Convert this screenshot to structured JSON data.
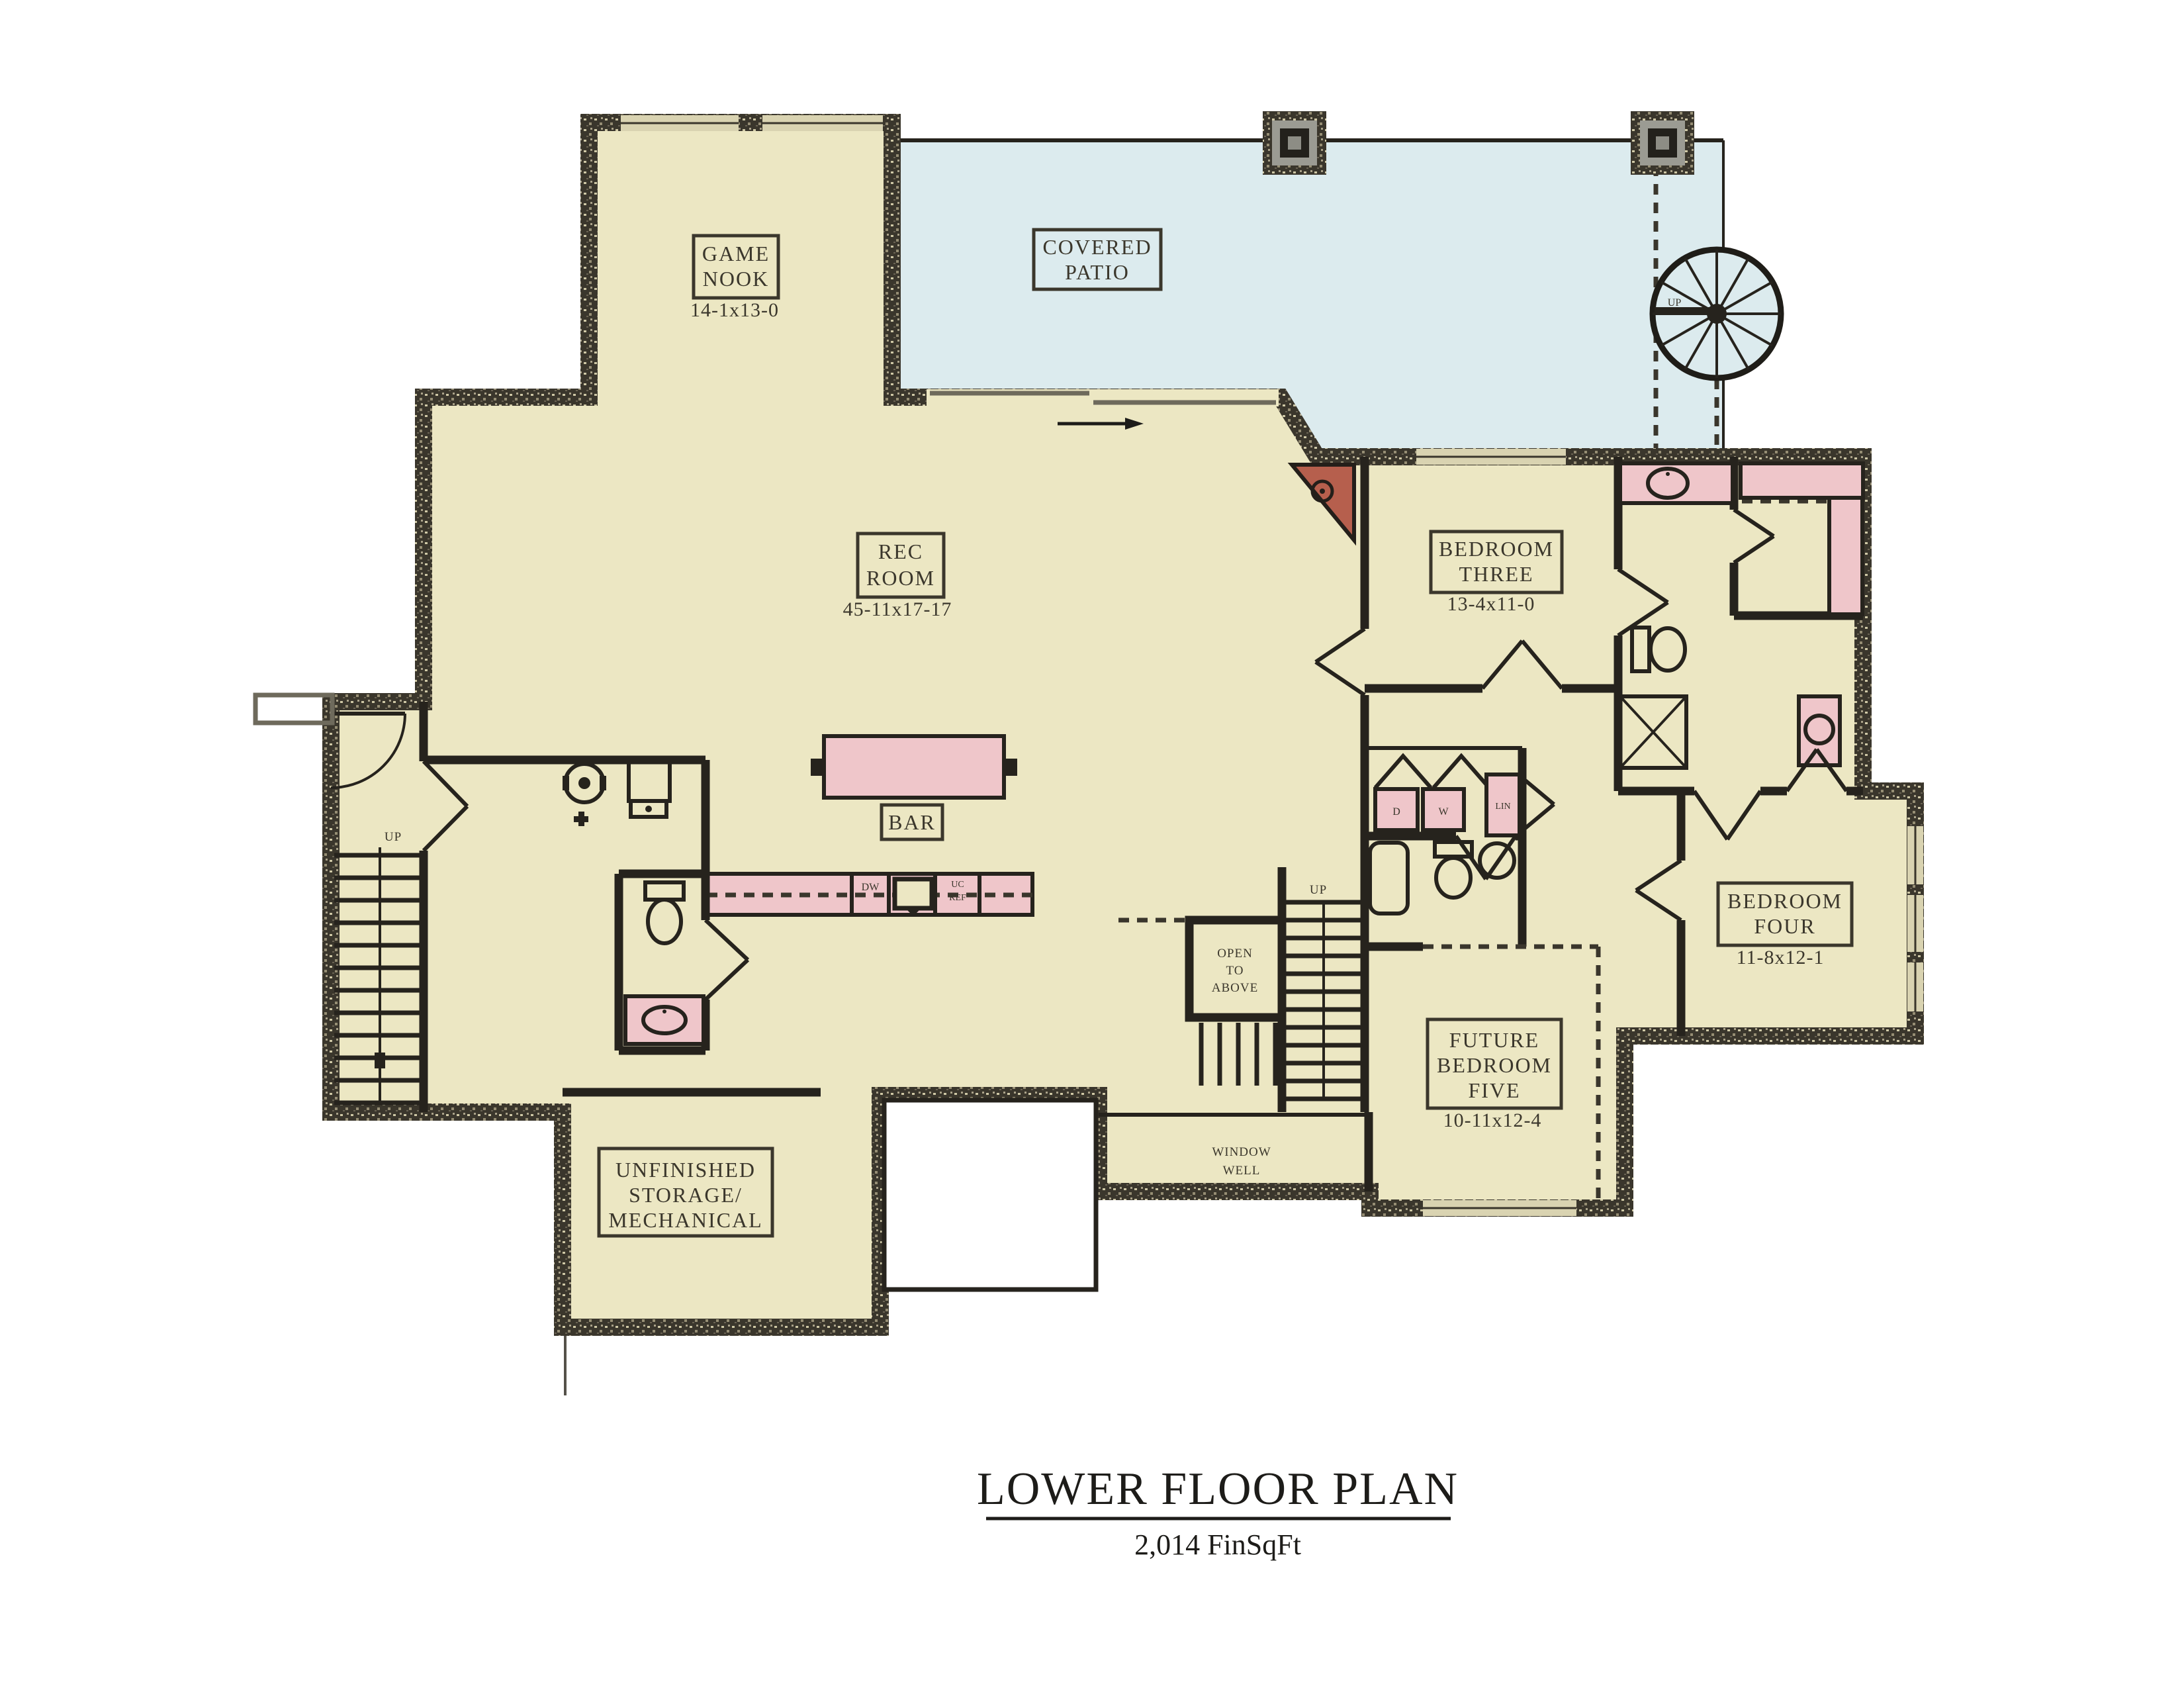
{
  "title": {
    "heading": "LOWER FLOOR PLAN",
    "subheading": "2,014 FinSqFt"
  },
  "palette": {
    "paper": "#ffffff",
    "room_fill": "#ece7c3",
    "patio_fill": "#dcebee",
    "fixture_pink": "#efc6ca",
    "wall_dark": "#26231d",
    "fireplace_red": "#b65f4d"
  },
  "rooms": {
    "game_nook": {
      "name_lines": [
        "GAME",
        "NOOK"
      ],
      "dim": "14-1x13-0"
    },
    "covered_patio": {
      "name_lines": [
        "COVERED",
        "PATIO"
      ]
    },
    "rec_room": {
      "name_lines": [
        "REC",
        "ROOM"
      ],
      "dim": "45-11x17-17"
    },
    "bar": {
      "name": "BAR"
    },
    "bedroom_three": {
      "name_lines": [
        "BEDROOM",
        "THREE"
      ],
      "dim": "13-4x11-0"
    },
    "bedroom_four": {
      "name_lines": [
        "BEDROOM",
        "FOUR"
      ],
      "dim": "11-8x12-1"
    },
    "future_bedroom_five": {
      "name_lines": [
        "FUTURE",
        "BEDROOM",
        "FIVE"
      ],
      "dim": "10-11x12-4"
    },
    "unfinished_storage": {
      "name_lines": [
        "UNFINISHED",
        "STORAGE/",
        "MECHANICAL"
      ]
    },
    "open_to_above": {
      "name_lines": [
        "OPEN",
        "TO",
        "ABOVE"
      ]
    },
    "window_well": {
      "name_lines": [
        "WINDOW",
        "WELL"
      ]
    }
  },
  "annotations": {
    "stair_up_left": "UP",
    "stair_up_center": "UP",
    "stair_up_spiral": "UP",
    "dryer": "D",
    "washer": "W",
    "linen": "LIN",
    "dishwasher": "DW",
    "uc_ref_lines": [
      "UC",
      "REF"
    ]
  }
}
